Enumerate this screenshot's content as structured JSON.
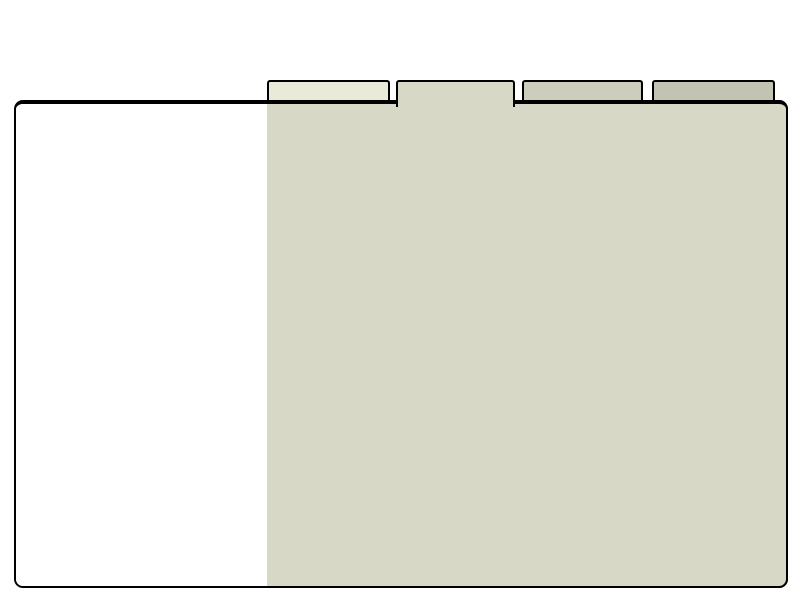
{
  "page_background": "#ffffff",
  "window": {
    "background": "#ffffff",
    "border_color": "#000000"
  },
  "notebook": {
    "page_background": "#d8d8c6",
    "selected_tab_index": 1,
    "tab_count": 4,
    "tabs": [
      {
        "id": "tab-1",
        "label": "",
        "color": "#eaead9",
        "selected": false
      },
      {
        "id": "tab-2",
        "label": "",
        "color": "#d8d8c6",
        "selected": true
      },
      {
        "id": "tab-3",
        "label": "",
        "color": "#cdcdbe",
        "selected": false
      },
      {
        "id": "tab-4",
        "label": "",
        "color": "#c3c3b4",
        "selected": false
      }
    ]
  },
  "colors": {
    "page-bg": "#ffffff",
    "window-bg": "#ffffff",
    "page-panel-bg": "#d8d8c6",
    "border-color": "#000000"
  }
}
